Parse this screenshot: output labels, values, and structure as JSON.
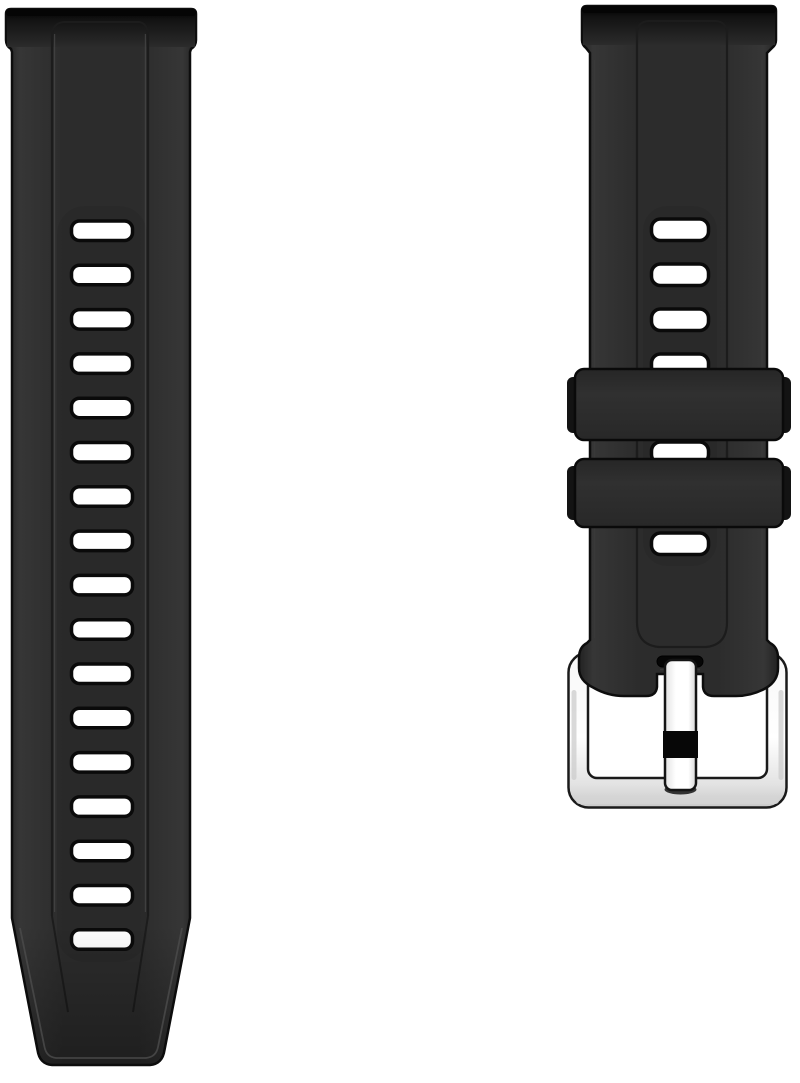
{
  "page": {
    "type": "product photo",
    "background": "#ffffff"
  },
  "product": {
    "name": "Black silicone quick-release smartwatch replacement band, two-piece set",
    "left_piece": "long tail strap with adjustment holes and tapered tip",
    "right_piece": "short buckle strap with two keeper loops and polished silver pin buckle"
  },
  "colors": {
    "background": "#ffffff",
    "strap_body": "#2d2d2d",
    "strap_outline": "#0d0d0d",
    "spring_bar_edge": "#050505",
    "hole_fill": "#ffffff",
    "hole_border": "#0a0a0a",
    "groove_dark": "#1c1c1c",
    "groove_light": "#454545",
    "keeper_face": "#2d2d2d",
    "keeper_shadow": "#131313",
    "keeper_outline": "#0a0a0a",
    "buckle_outline": "#1a1a1a",
    "buckle_inner_fill": "#ffffff",
    "tongue_band": "#070707",
    "tip_contour": "#4a4a4a"
  },
  "left_strap": {
    "holes": {
      "count": 17,
      "spacing": 44.3
    }
  },
  "right_strap": {
    "holes_top": {
      "count": 4,
      "spacing": 45
    },
    "keeper_count": 2,
    "buckle_type": "silver pin buckle"
  }
}
